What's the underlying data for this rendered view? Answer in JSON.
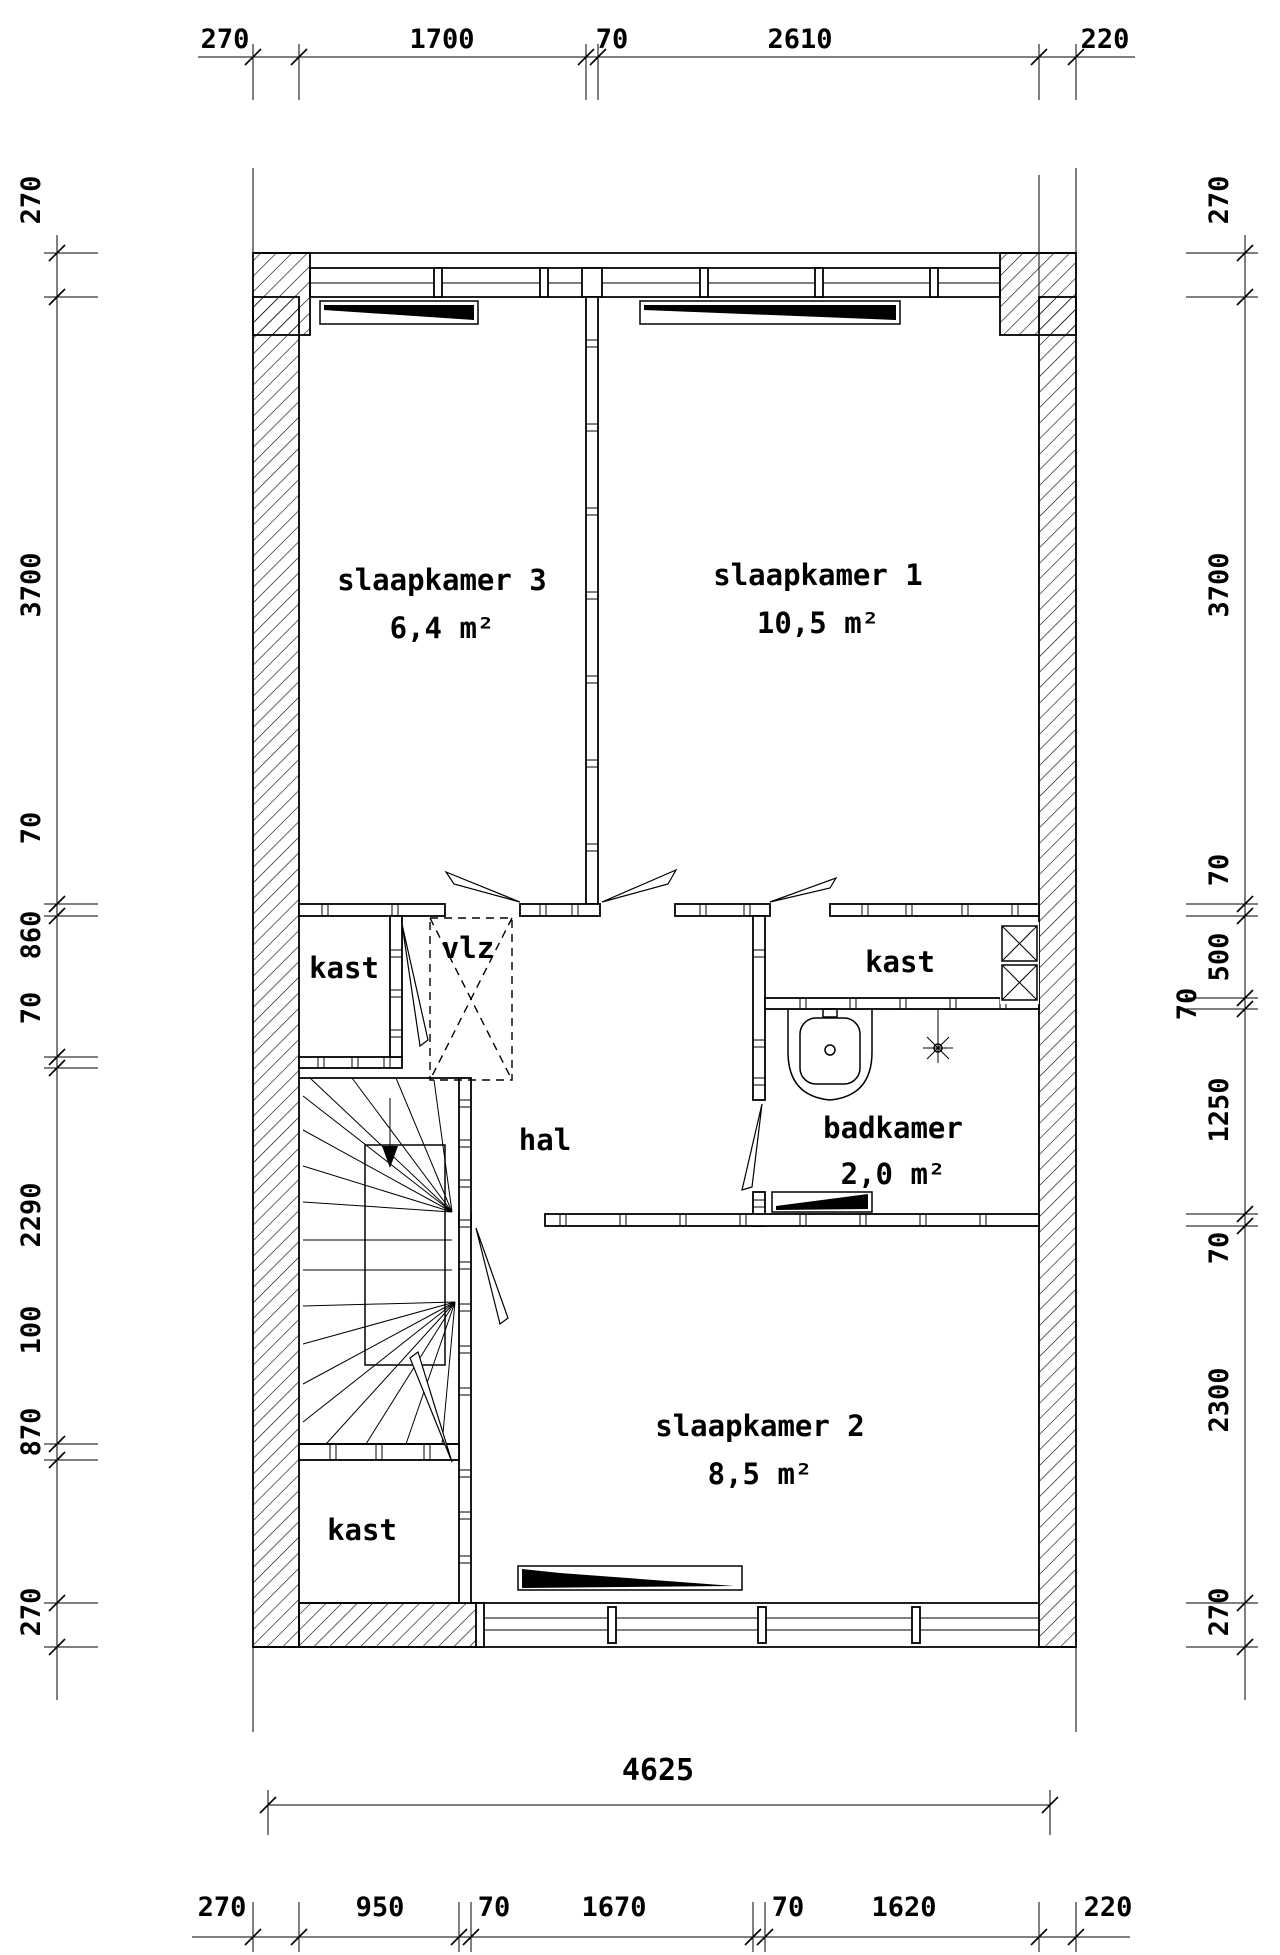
{
  "plan": {
    "rooms": {
      "slaapkamer3": {
        "name": "slaapkamer 3",
        "area": "6,4 m²"
      },
      "slaapkamer1": {
        "name": "slaapkamer 1",
        "area": "10,5 m²"
      },
      "slaapkamer2": {
        "name": "slaapkamer 2",
        "area": "8,5 m²"
      },
      "badkamer": {
        "name": "badkamer",
        "area": "2,0 m²"
      },
      "hal": {
        "name": "hal"
      },
      "vlz": {
        "name": "vlz"
      },
      "kast_middle_left": {
        "name": "kast"
      },
      "kast_middle_right": {
        "name": "kast"
      },
      "kast_bottom": {
        "name": "kast"
      }
    },
    "dimensions": {
      "top": [
        "270",
        "1700",
        "70",
        "2610",
        "220"
      ],
      "left": [
        "270",
        "3700",
        "70",
        "860",
        "70",
        "2290",
        "100",
        "870",
        "270"
      ],
      "right": [
        "270",
        "3700",
        "70",
        "500",
        "70",
        "1250",
        "70",
        "2300",
        "270"
      ],
      "bottom_total": "4625",
      "bottom": [
        "270",
        "950",
        "70",
        "1670",
        "70",
        "1620",
        "220"
      ]
    },
    "colors": {
      "line": "#000000",
      "background": "#ffffff"
    }
  }
}
